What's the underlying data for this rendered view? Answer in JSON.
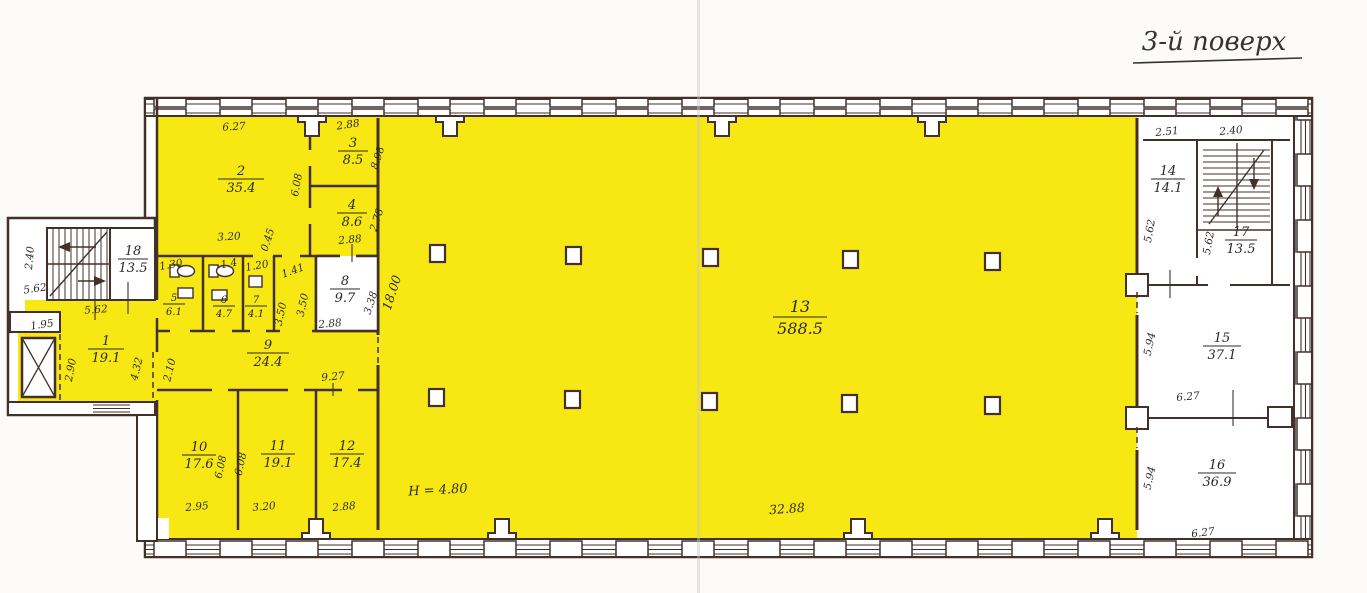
{
  "title": "3-й поверх",
  "colors": {
    "room_highlight": "#f7e814",
    "wall_line": "#43302a",
    "ink": "#2f2b28",
    "paper": "#fcfbf7"
  },
  "rooms": {
    "r1": {
      "num": "1",
      "area": "19.1"
    },
    "r2": {
      "num": "2",
      "area": "35.4"
    },
    "r3": {
      "num": "3",
      "area": "8.5"
    },
    "r4": {
      "num": "4",
      "area": "8.6"
    },
    "r5": {
      "num": "5",
      "area": "6.1"
    },
    "r6": {
      "num": "6",
      "area": "4.7"
    },
    "r7": {
      "num": "7",
      "area": "4.1"
    },
    "r8": {
      "num": "8",
      "area": "9.7"
    },
    "r9": {
      "num": "9",
      "area": "24.4"
    },
    "r10": {
      "num": "10",
      "area": "17.6"
    },
    "r11": {
      "num": "11",
      "area": "19.1"
    },
    "r12": {
      "num": "12",
      "area": "17.4"
    },
    "r13": {
      "num": "13",
      "area": "588.5"
    },
    "r14": {
      "num": "14",
      "area": "14.1"
    },
    "r15": {
      "num": "15",
      "area": "37.1"
    },
    "r16": {
      "num": "16",
      "area": "36.9"
    },
    "r17": {
      "num": "17",
      "area": "13.5"
    },
    "r18": {
      "num": "18",
      "area": "13.5"
    }
  },
  "dims": {
    "annex_stair_depth": "2.40",
    "annex_stair_width": "5.62",
    "room1_top": "5.62",
    "lobby_width": "1.95",
    "elevator_side": "2.90",
    "room1_right": "4.32",
    "room9_left": "2.10",
    "room2_top": "6.27",
    "room2_bottom": "3.20",
    "room2_right": "6.08",
    "room3_top": "2.88",
    "room3_right": "8.98",
    "room4_right": "2.78",
    "room4_bottom": "2.88",
    "niche": "0.45",
    "room5_top": "1.30",
    "room6_top": "1.4",
    "room7_top": "1.20",
    "room8_door": "1.41",
    "corridor_left": "3.50",
    "corridor_right": "3.50",
    "room8_bottom": "2.88",
    "room8_right": "3.38",
    "room9_bottom": "9.27",
    "room10_right": "6.08",
    "room11_left": "6.08",
    "room10_bottom": "2.95",
    "room11_bottom": "3.20",
    "room12_bottom": "2.88",
    "hall_depth": "18.00",
    "hall_width": "32.88",
    "room14_top": "2.51",
    "stair2_top": "2.40",
    "room14_left": "5.62",
    "room17_left": "5.62",
    "room15_left": "5.94",
    "room15_bottom": "6.27",
    "room16_left": "5.94",
    "room16_bottom": "6.27"
  },
  "annotations": {
    "ceiling_height": "H = 4.80"
  }
}
